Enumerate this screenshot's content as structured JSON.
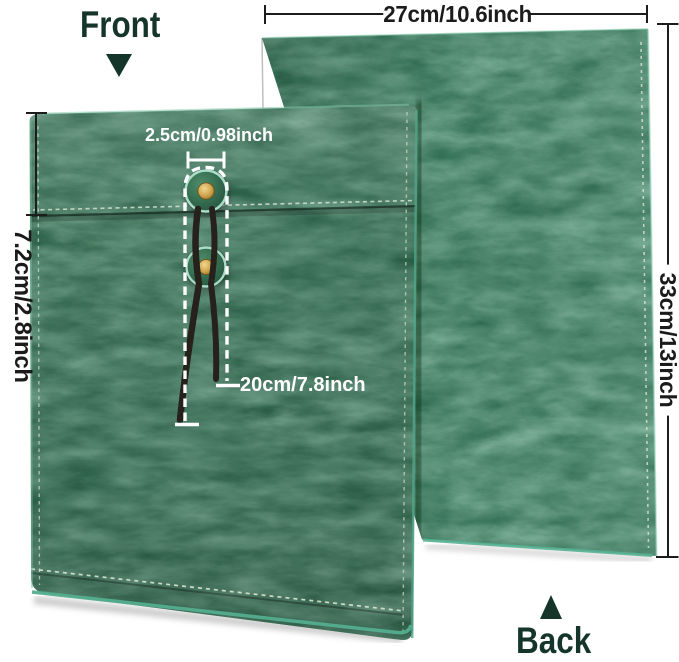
{
  "view_labels": {
    "front": "Front",
    "back": "Back"
  },
  "dimension_labels": {
    "width": "27cm/10.6inch",
    "height": "33cm/13inch",
    "flap_depth": "7.2cm/2.8inch",
    "button_width": "2.5cm/0.98inch",
    "string_length": "20cm/7.8inch"
  },
  "icons": {
    "front_arrow": "triangle-down-icon",
    "back_arrow": "triangle-up-icon"
  },
  "colors": {
    "leather_front": "#2b5f46",
    "leather_back": "#2f6e52",
    "edge_trim": "#58b092",
    "stitching": "#dde8da",
    "button_ring": "#aaddc8",
    "grommet_gold": "#cfa64f",
    "string": "#26211b",
    "annotation_text": "#ffffff",
    "dimension_line": "#1b1b1b",
    "label_text": "#15352a",
    "background": "#ffffff"
  }
}
